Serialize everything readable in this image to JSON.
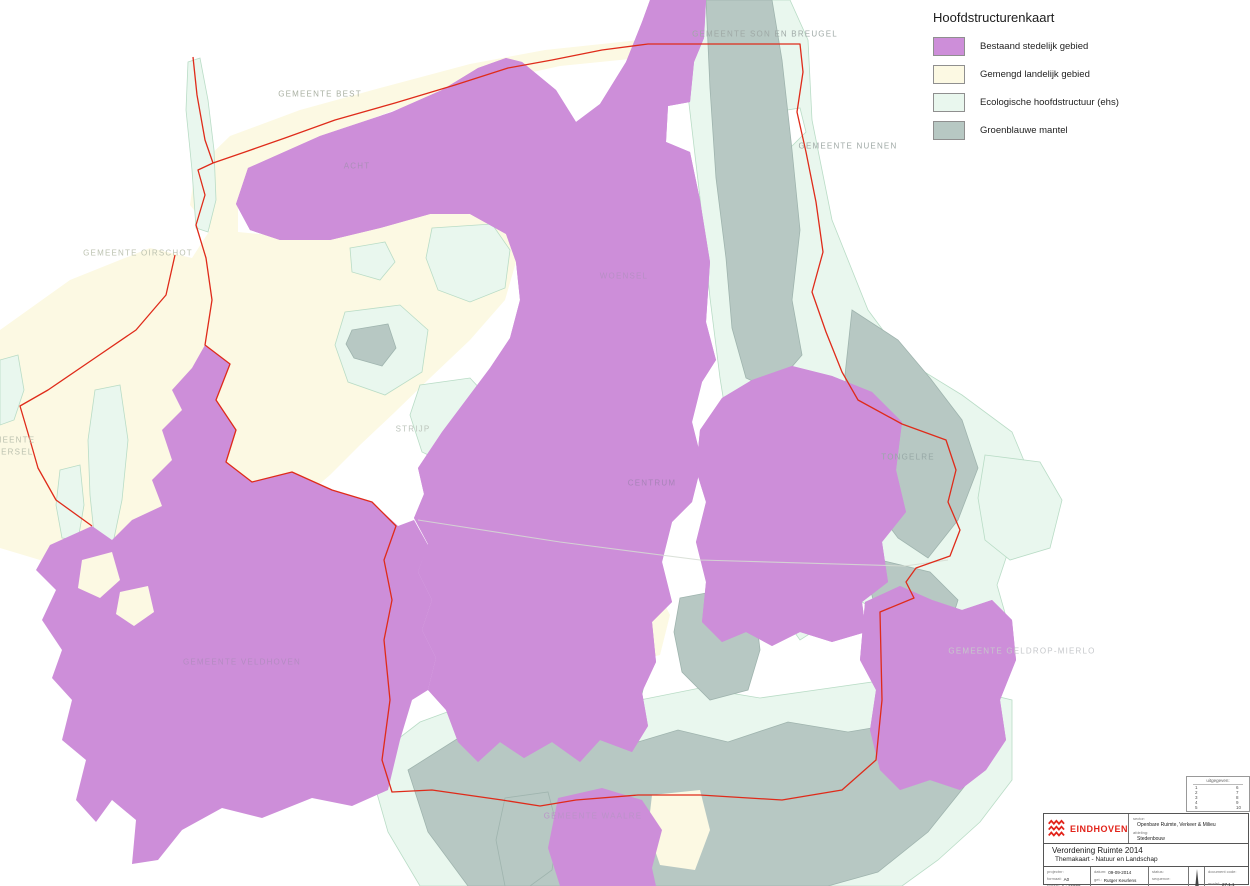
{
  "colors": {
    "urban": "#cd8ed9",
    "rural": "#fcf9e3",
    "ehs": "#e9f7ee",
    "mantel": "#b7c8c3",
    "boundary": "#df2b1a",
    "logo_red": "#e2231a"
  },
  "legend": {
    "title": "Hoofdstructurenkaart",
    "items": [
      {
        "label": "Bestaand stedelijk gebied",
        "color": "#cd8ed9"
      },
      {
        "label": "Gemengd landelijk gebied",
        "color": "#fcf9e3"
      },
      {
        "label": "Ecologische hoofdstructuur (ehs)",
        "color": "#e9f7ee"
      },
      {
        "label": "Groenblauwe mantel",
        "color": "#b7c8c3"
      }
    ]
  },
  "map": {
    "labels": [
      {
        "id": "gemeente-best",
        "text": "GEMEENTE BEST",
        "x": 320,
        "y": 94,
        "color": "#a9b0a2"
      },
      {
        "id": "gemeente-son-en-breugel",
        "text": "GEMEENTE SON EN BREUGEL",
        "x": 765,
        "y": 34,
        "color": "#9fa9a6"
      },
      {
        "id": "gemeente-nuenen",
        "text": "GEMEENTE NUENEN",
        "x": 848,
        "y": 146,
        "color": "#9fa9a6"
      },
      {
        "id": "gemeente-oirschot",
        "text": "GEMEENTE OIRSCHOT",
        "x": 138,
        "y": 253,
        "color": "#bcc2b0"
      },
      {
        "id": "acht",
        "text": "ACHT",
        "x": 357,
        "y": 166,
        "color": "#ab8fb8"
      },
      {
        "id": "woensel",
        "text": "WOENSEL",
        "x": 624,
        "y": 276,
        "color": "#b78fc5"
      },
      {
        "id": "strijp",
        "text": "STRIJP",
        "x": 413,
        "y": 429,
        "color": "#bcc4bb"
      },
      {
        "id": "tongelre",
        "text": "TONGELRE",
        "x": 908,
        "y": 457,
        "color": "#97a8a6"
      },
      {
        "id": "centrum",
        "text": "CENTRUM",
        "x": 652,
        "y": 483,
        "color": "#a883b8"
      },
      {
        "id": "gemeente-eersel-line1",
        "text": "GEMEENTE",
        "x": 8,
        "y": 440,
        "color": "#bcc2b0"
      },
      {
        "id": "gemeente-eersel-line2",
        "text": "EERSEL",
        "x": 14,
        "y": 452,
        "color": "#bcc2b0"
      },
      {
        "id": "gemeente-veldhoven",
        "text": "GEMEENTE VELDHOVEN",
        "x": 242,
        "y": 662,
        "color": "#b48cc2"
      },
      {
        "id": "gemeente-geldrop-mierlo",
        "text": "GEMEENTE GELDROP-MIERLO",
        "x": 1022,
        "y": 651,
        "color": "#c6c8cb"
      },
      {
        "id": "gemeente-waalre",
        "text": "GEMEENTE WAALRE",
        "x": 593,
        "y": 816,
        "color": "#bb93c9"
      }
    ]
  },
  "issued_box": {
    "header": "uitgegeven:",
    "column1": [
      "1",
      "2",
      "3",
      "4",
      "5"
    ],
    "column2": [
      "6",
      "7",
      "8",
      "9",
      "10"
    ]
  },
  "title_block": {
    "logo_text": "EINDHOVEN",
    "sector_label": "sector:",
    "sector_value": "Openbare Ruimte, Verkeer & Milieu",
    "afdeling_label": "afdeling:",
    "afdeling_value": "Stedenbouw",
    "title_line1": "Verordening Ruimte 2014",
    "title_line2": "Themakaart - Natuur en Landschap",
    "projectnr_label": "projectnr:",
    "formaat_label": "formaat:",
    "formaat_value": "A0",
    "schaal_label": "schaal:",
    "schaal_value": "1 : 15000",
    "datum_label": "datum:",
    "datum_value": "09-09-2014",
    "getekend_label": "get.:",
    "getekend_value": "Rutger Keurlens",
    "gezien_label": "gez.:",
    "status_label": "status:",
    "sequence_label": "sequence:",
    "document_code_label": "document code:",
    "model_label": "model:",
    "model_value": "27.1.1"
  }
}
